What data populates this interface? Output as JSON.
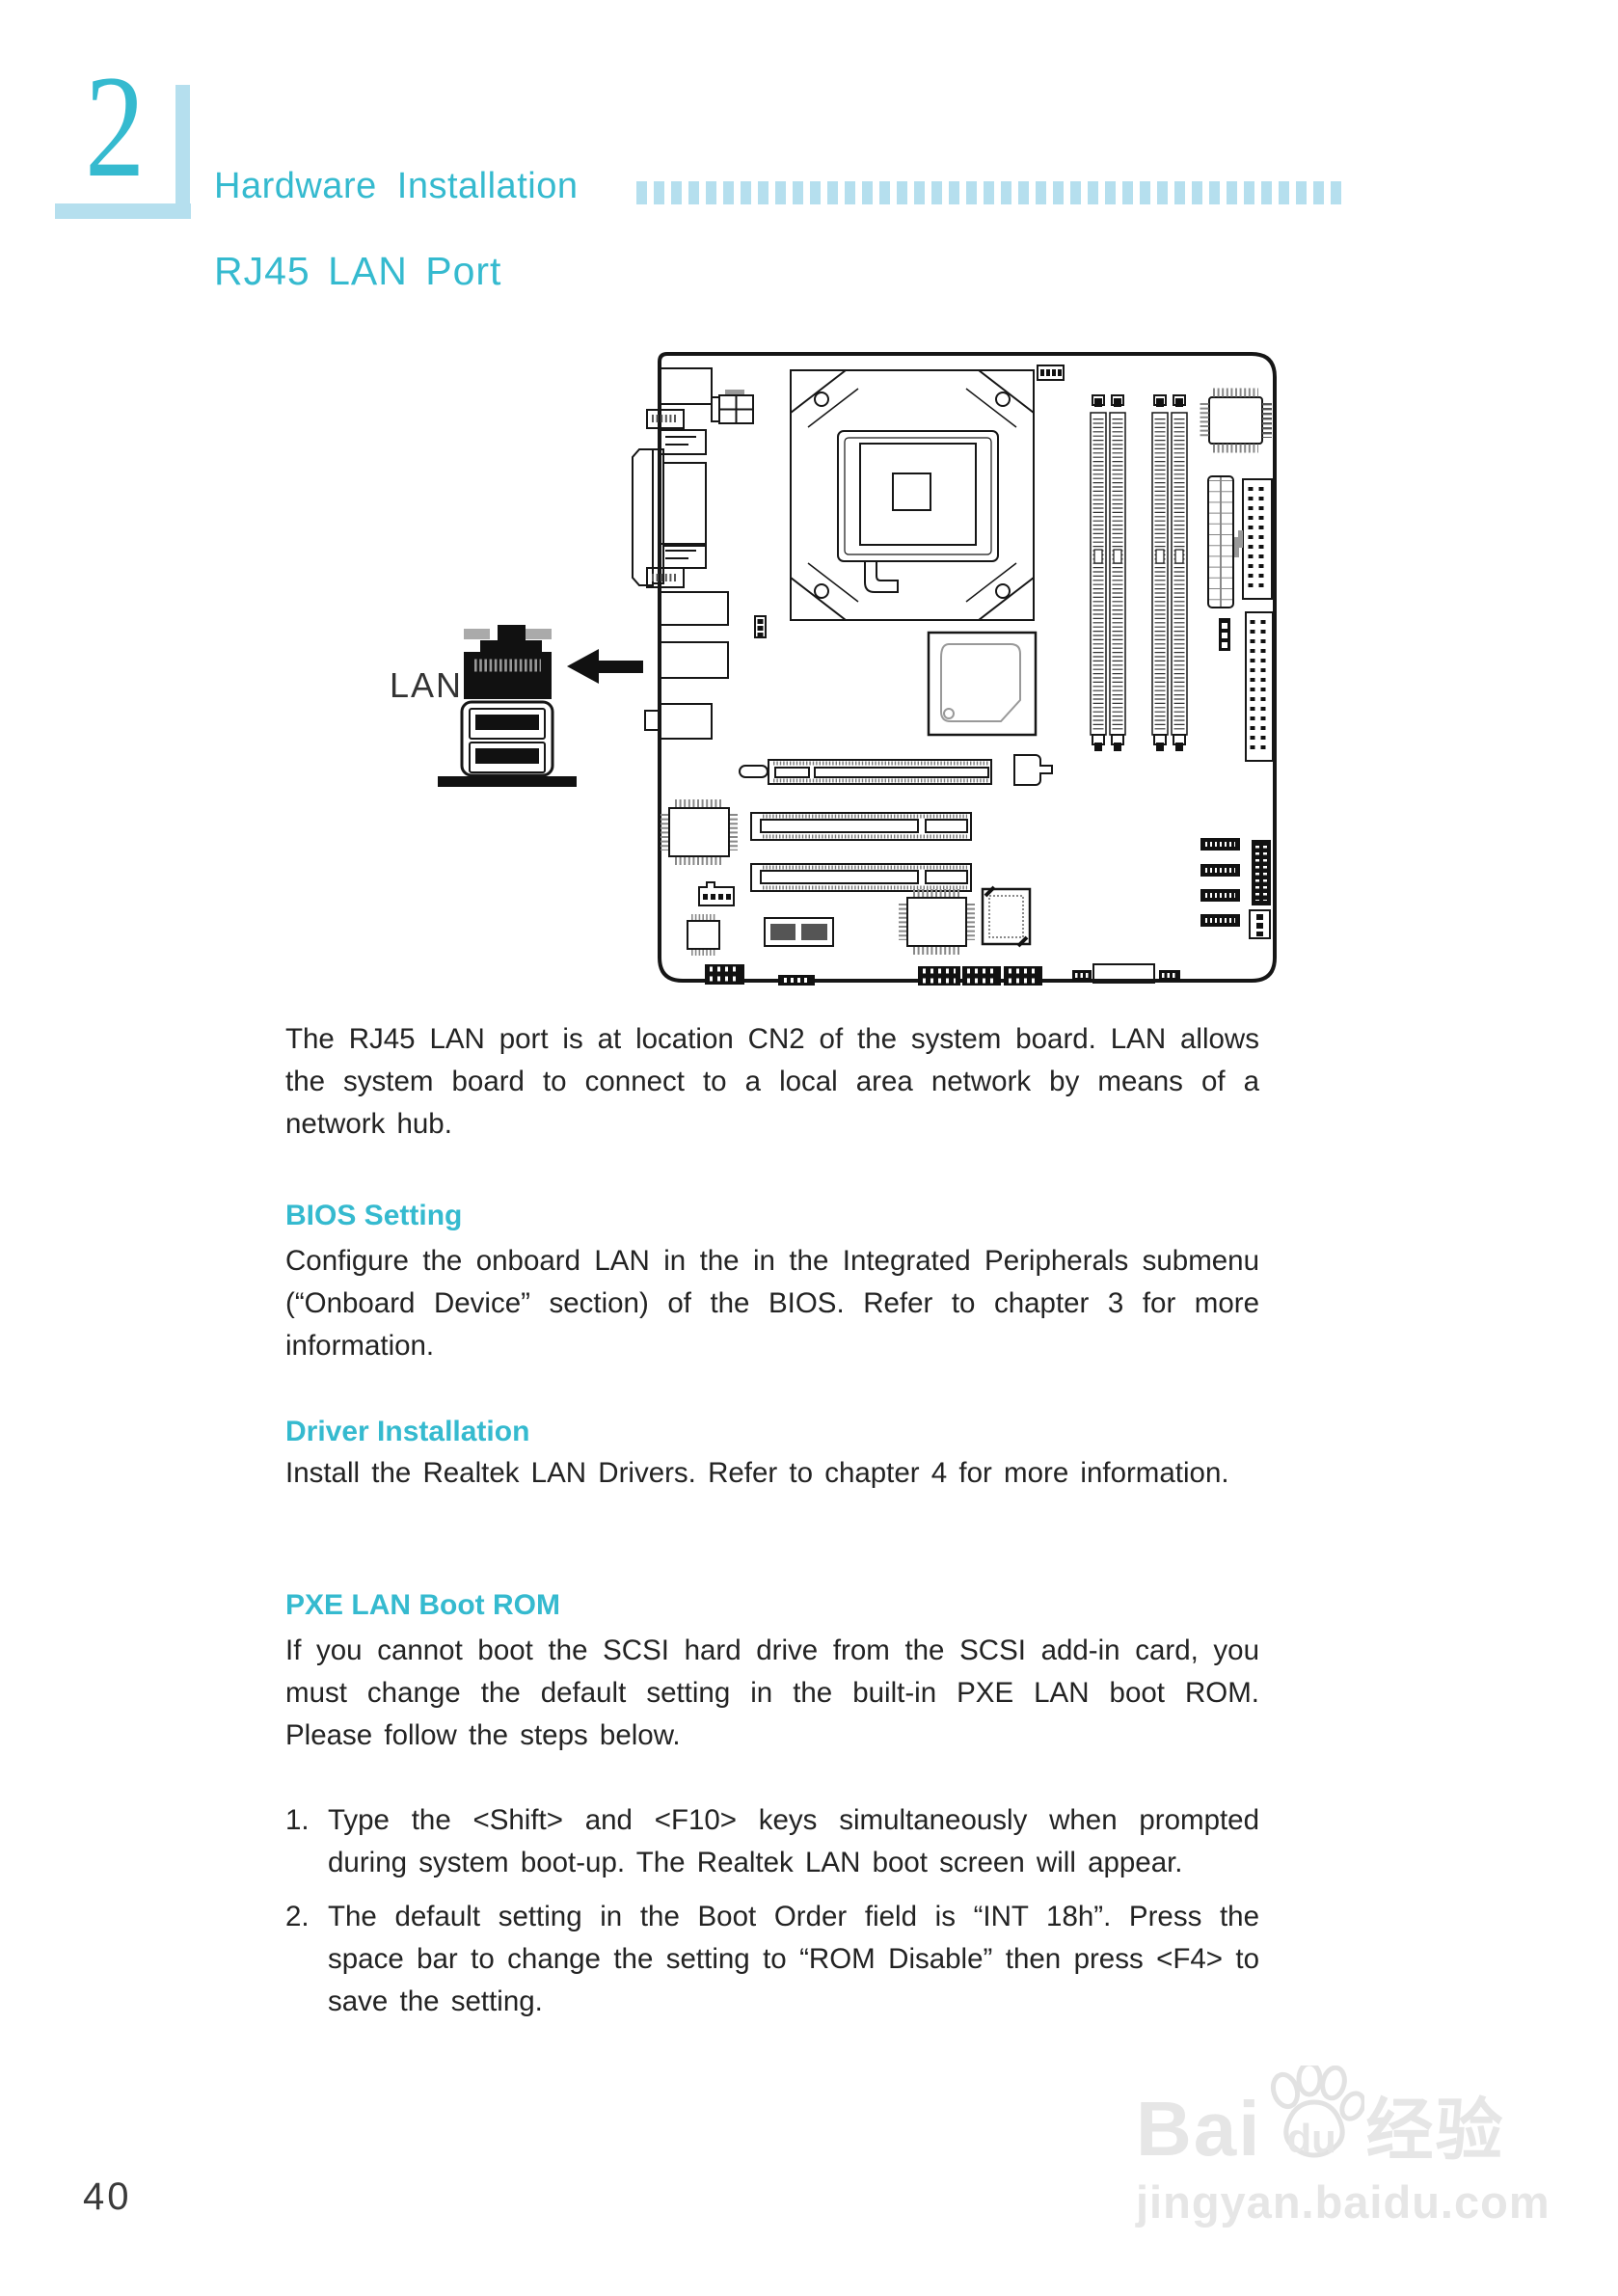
{
  "colors": {
    "accent": "#35bacf",
    "light": "#b5dfee",
    "ink": "#232323",
    "watermark": "#e6e6e6"
  },
  "chapter": {
    "number": "2"
  },
  "header": {
    "title": "Hardware Installation",
    "dots_count": 41
  },
  "page": {
    "section_title": "RJ45 LAN Port",
    "page_number": "40"
  },
  "diagram": {
    "lan_label": "LAN"
  },
  "content": {
    "intro": "The RJ45 LAN port is at location CN2 of the system board. LAN allows the system board to connect to a local area network by means of a network hub.",
    "sections": [
      {
        "heading": "BIOS Setting",
        "body": "Configure the onboard LAN in the in the Integrated Peripherals submenu (“Onboard Device” section) of the BIOS. Refer to chapter 3 for more information."
      },
      {
        "heading": "Driver Installation",
        "body": "Install the Realtek LAN Drivers. Refer to chapter 4 for more information."
      },
      {
        "heading": "PXE LAN Boot ROM",
        "body": "If you cannot boot the SCSI hard drive from the SCSI add-in card, you must change the default setting in the built-in PXE LAN boot ROM. Please follow the steps below."
      }
    ],
    "steps": [
      {
        "num": "1.",
        "text": "Type the <Shift> and <F10> keys simultaneously when prompted during system boot-up. The Realtek LAN boot screen will appear."
      },
      {
        "num": "2.",
        "text": "The default setting in the Boot Order field is “INT 18h”. Press the space bar to change the setting to “ROM Disable” then press <F4> to save the setting."
      }
    ]
  },
  "watermark": {
    "brand_left": "Bai",
    "brand_paw": "du",
    "brand_right": "经验",
    "url": "jingyan.baidu.com"
  }
}
